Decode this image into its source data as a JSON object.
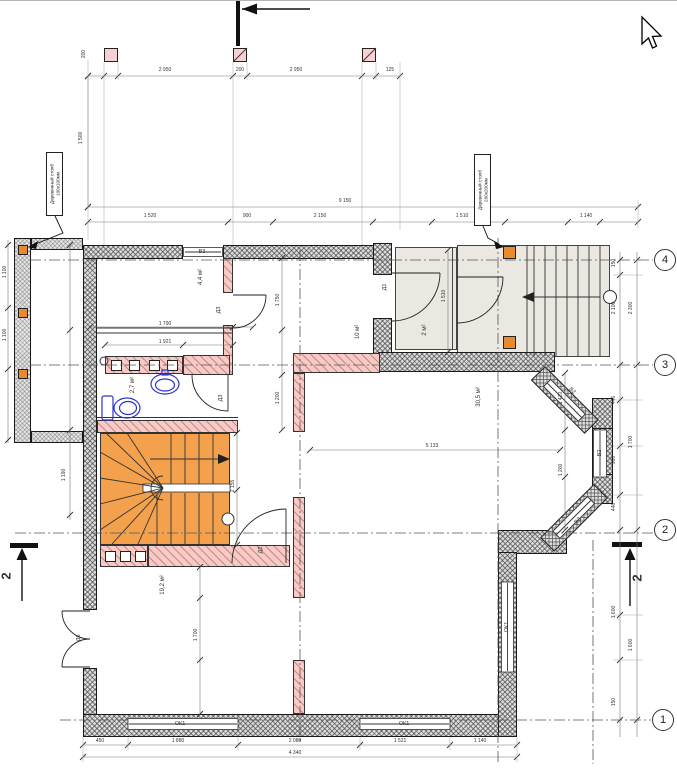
{
  "annotations": {
    "post_label_left": {
      "line1": "Деревянный столб",
      "line2": "100х100мм"
    },
    "post_label_right": {
      "line1": "Деревянный столб",
      "line2": "200х200мм"
    }
  },
  "rooms": [
    {
      "id": "room-upper-left",
      "area": "4,4 м²"
    },
    {
      "id": "hall",
      "area": "10 м²"
    },
    {
      "id": "bathroom",
      "area": "2,7 м²"
    },
    {
      "id": "vestibule",
      "area": "2 м²"
    },
    {
      "id": "living-room",
      "area": "30,5 м²"
    },
    {
      "id": "room-lower-left",
      "area": "19,2 м²"
    }
  ],
  "doors": [
    {
      "label": "Д1"
    },
    {
      "label": "Д2"
    },
    {
      "label": "Д3"
    },
    {
      "label": "Д3"
    },
    {
      "label": "Д6"
    }
  ],
  "windows": [
    {
      "label": "В3"
    },
    {
      "label": "ОК1"
    },
    {
      "label": "ОК1"
    },
    {
      "label": "ОК1"
    },
    {
      "label": "В2"
    },
    {
      "label": "В2"
    },
    {
      "label": "В2"
    }
  ],
  "grid_axes": [
    {
      "label": "4"
    },
    {
      "label": "3"
    },
    {
      "label": "2"
    },
    {
      "label": "1"
    }
  ],
  "section_marks": {
    "left": "2",
    "right": "2"
  },
  "colors": {
    "wall_fill": "#dcdcdc",
    "partition_pink": "#f6cbc7",
    "stair_orange": "#f3a14c",
    "post_orange": "#e98b2d",
    "post_pink": "#f8cfd4",
    "porch_floor": "#ebe7e1",
    "fixture_blue": "#2d35c8"
  },
  "dimensions": [
    {
      "t": "200",
      "x": 84,
      "y": 54,
      "r": -90
    },
    {
      "t": "2 950",
      "x": 165,
      "y": 70,
      "r": 0
    },
    {
      "t": "200",
      "x": 240,
      "y": 70,
      "r": 0
    },
    {
      "t": "2 950",
      "x": 296,
      "y": 70,
      "r": 0
    },
    {
      "t": "125",
      "x": 390,
      "y": 70,
      "r": 0
    },
    {
      "t": "1 500",
      "x": 81,
      "y": 138,
      "r": -90
    },
    {
      "t": "9 150",
      "x": 345,
      "y": 201,
      "r": 0
    },
    {
      "t": "1 520",
      "x": 150,
      "y": 216,
      "r": 0
    },
    {
      "t": "900",
      "x": 247,
      "y": 216,
      "r": 0
    },
    {
      "t": "2 150",
      "x": 320,
      "y": 216,
      "r": 0
    },
    {
      "t": "1 510",
      "x": 462,
      "y": 216,
      "r": 0
    },
    {
      "t": "1 140",
      "x": 586,
      "y": 216,
      "r": 0
    },
    {
      "t": "150",
      "x": 614,
      "y": 263,
      "r": -90
    },
    {
      "t": "2 100",
      "x": 614,
      "y": 308,
      "r": -90
    },
    {
      "t": "2 300",
      "x": 631,
      "y": 308,
      "r": -90
    },
    {
      "t": "446",
      "x": 614,
      "y": 400,
      "r": -90
    },
    {
      "t": "900",
      "x": 614,
      "y": 460,
      "r": -90
    },
    {
      "t": "1 700",
      "x": 631,
      "y": 442,
      "r": -90
    },
    {
      "t": "446",
      "x": 614,
      "y": 507,
      "r": -90
    },
    {
      "t": "1 600",
      "x": 614,
      "y": 612,
      "r": -90
    },
    {
      "t": "1 600",
      "x": 631,
      "y": 645,
      "r": -90
    },
    {
      "t": "150",
      "x": 614,
      "y": 702,
      "r": -90
    },
    {
      "t": "450",
      "x": 100,
      "y": 741,
      "r": 0
    },
    {
      "t": "1 880",
      "x": 178,
      "y": 741,
      "r": 0
    },
    {
      "t": "2 080",
      "x": 295,
      "y": 741,
      "r": 0
    },
    {
      "t": "1 521",
      "x": 400,
      "y": 741,
      "r": 0
    },
    {
      "t": "1 140",
      "x": 480,
      "y": 741,
      "r": 0
    },
    {
      "t": "4 340",
      "x": 295,
      "y": 753,
      "r": 0
    },
    {
      "t": "1 100",
      "x": 5,
      "y": 272,
      "r": -90
    },
    {
      "t": "1 100",
      "x": 5,
      "y": 335,
      "r": -90
    },
    {
      "t": "1 190",
      "x": 64,
      "y": 475,
      "r": -90
    },
    {
      "t": "1 790",
      "x": 165,
      "y": 324,
      "r": 0
    },
    {
      "t": "1 921",
      "x": 165,
      "y": 342,
      "r": 0
    },
    {
      "t": "1 750",
      "x": 278,
      "y": 300,
      "r": -90
    },
    {
      "t": "1 200",
      "x": 278,
      "y": 398,
      "r": -90
    },
    {
      "t": "5 133",
      "x": 432,
      "y": 446,
      "r": 0
    },
    {
      "t": "1 420",
      "x": 561,
      "y": 398,
      "r": -90
    },
    {
      "t": "1 200",
      "x": 561,
      "y": 470,
      "r": -90
    },
    {
      "t": "1 510",
      "x": 444,
      "y": 296,
      "r": -90
    },
    {
      "t": "2 155",
      "x": 233,
      "y": 486,
      "r": -90
    },
    {
      "t": "1 700",
      "x": 196,
      "y": 635,
      "r": -90
    }
  ],
  "dim_lines": {
    "h": [
      {
        "y": 76,
        "x1": 88,
        "x2": 400,
        "ticks": [
          88,
          104,
          118,
          233,
          247,
          362,
          376,
          400
        ]
      },
      {
        "y": 207,
        "x1": 88,
        "x2": 638,
        "ticks": [
          88,
          638
        ]
      },
      {
        "y": 222,
        "x1": 88,
        "x2": 638,
        "ticks": [
          88,
          228,
          273,
          373,
          432,
          505,
          568,
          600,
          638
        ]
      },
      {
        "y": 745,
        "x1": 83,
        "x2": 517,
        "ticks": [
          83,
          128,
          238,
          360,
          450,
          517
        ]
      },
      {
        "y": 757,
        "x1": 83,
        "x2": 517,
        "ticks": [
          83,
          517
        ]
      },
      {
        "y": 327,
        "x1": 90,
        "x2": 253,
        "ticks": [
          90,
          233,
          253
        ]
      },
      {
        "y": 345,
        "x1": 105,
        "x2": 233,
        "ticks": [
          105,
          183,
          233
        ]
      },
      {
        "y": 450,
        "x1": 310,
        "x2": 560,
        "ticks": [
          310,
          560
        ]
      }
    ],
    "v": [
      {
        "x": 88,
        "y1": 76,
        "y2": 207,
        "ticks": [
          76,
          207
        ]
      },
      {
        "x": 8,
        "y1": 240,
        "y2": 443,
        "ticks": [
          245,
          308,
          369,
          440
        ]
      },
      {
        "x": 70,
        "y1": 245,
        "y2": 520,
        "ticks": [
          245,
          330,
          430,
          515
        ]
      },
      {
        "x": 282,
        "y1": 258,
        "y2": 430,
        "ticks": [
          258,
          330,
          375,
          430
        ]
      },
      {
        "x": 565,
        "y1": 373,
        "y2": 530,
        "ticks": [
          373,
          430,
          477,
          530
        ]
      },
      {
        "x": 448,
        "y1": 250,
        "y2": 352,
        "ticks": [
          250,
          352
        ]
      },
      {
        "x": 237,
        "y1": 433,
        "y2": 545,
        "ticks": [
          433,
          490,
          545
        ]
      },
      {
        "x": 200,
        "y1": 567,
        "y2": 714,
        "ticks": [
          567,
          598,
          660,
          714
        ]
      },
      {
        "x": 620,
        "y1": 252,
        "y2": 737,
        "ticks": [
          260,
          275,
          365,
          400,
          446,
          495,
          530,
          615,
          660,
          720
        ]
      },
      {
        "x": 637,
        "y1": 252,
        "y2": 737,
        "ticks": [
          260,
          365,
          530,
          720
        ]
      }
    ]
  },
  "axis_lines": {
    "h": [
      {
        "y": 260,
        "x1": 30,
        "x2": 653
      },
      {
        "y": 365,
        "x1": 30,
        "x2": 653
      },
      {
        "y": 533,
        "x1": 15,
        "x2": 653
      },
      {
        "y": 720,
        "x1": 60,
        "x2": 651
      }
    ],
    "v": [
      {
        "x": 300,
        "y1": 250,
        "y2": 742
      },
      {
        "x": 498,
        "y1": 238,
        "y2": 764
      },
      {
        "x": 593,
        "y1": 540,
        "y2": 764
      }
    ]
  },
  "ext_lines": {
    "v": [
      {
        "x": 88,
        "y1": 60,
        "y2": 240
      },
      {
        "x": 104,
        "y1": 62,
        "y2": 245
      },
      {
        "x": 118,
        "y1": 62,
        "y2": 80
      },
      {
        "x": 233,
        "y1": 62,
        "y2": 245
      },
      {
        "x": 247,
        "y1": 62,
        "y2": 80
      },
      {
        "x": 362,
        "y1": 62,
        "y2": 245
      },
      {
        "x": 376,
        "y1": 62,
        "y2": 80
      },
      {
        "x": 400,
        "y1": 62,
        "y2": 230
      },
      {
        "x": 638,
        "y1": 200,
        "y2": 228
      },
      {
        "x": 83,
        "y1": 737,
        "y2": 762
      },
      {
        "x": 128,
        "y1": 737,
        "y2": 750
      },
      {
        "x": 238,
        "y1": 737,
        "y2": 750
      },
      {
        "x": 360,
        "y1": 737,
        "y2": 750
      },
      {
        "x": 450,
        "y1": 737,
        "y2": 750
      },
      {
        "x": 517,
        "y1": 737,
        "y2": 762
      }
    ],
    "h": [
      {
        "y": 275,
        "x1": 613,
        "x2": 643
      },
      {
        "y": 400,
        "x1": 613,
        "x2": 643
      },
      {
        "y": 446,
        "x1": 613,
        "x2": 643
      },
      {
        "y": 495,
        "x1": 613,
        "x2": 643
      },
      {
        "y": 615,
        "x1": 613,
        "x2": 643
      },
      {
        "y": 660,
        "x1": 613,
        "x2": 643
      }
    ]
  }
}
